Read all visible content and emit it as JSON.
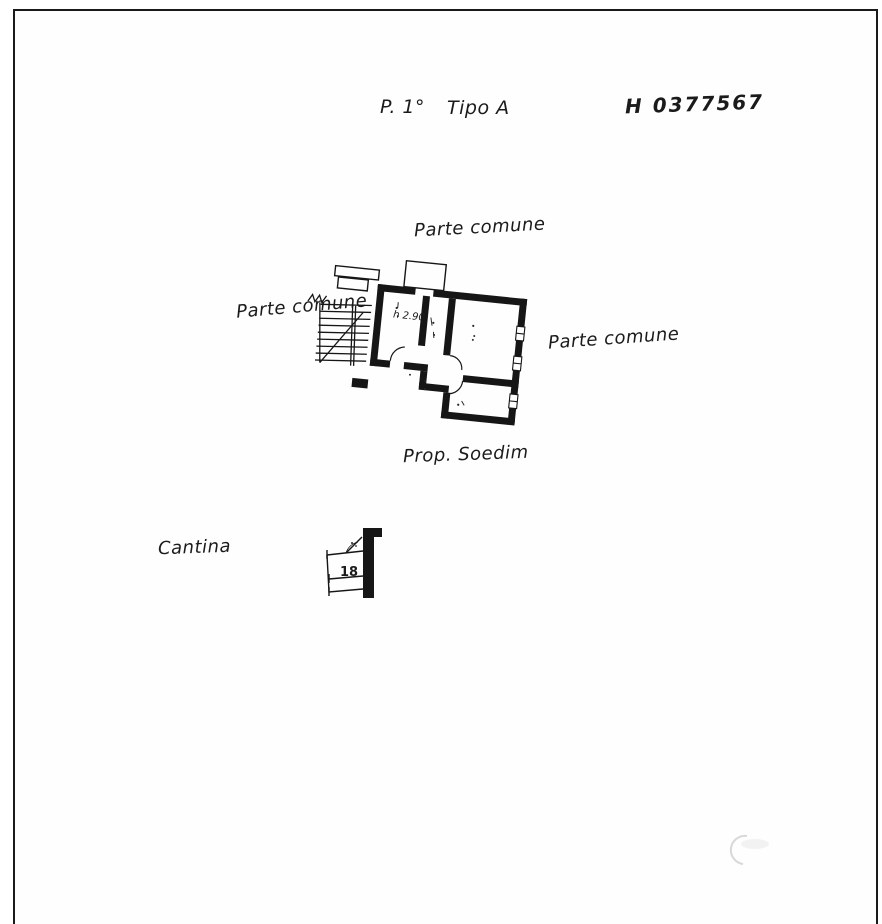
{
  "page": {
    "background": "#ffffff",
    "ink_color": "#1b1b1b",
    "border_color": "#1a1a1a",
    "faint_stamp_color": "#d8d8d8"
  },
  "header": {
    "floor_label": "P. 1°",
    "type_label": "Tipo A",
    "stamp_number": "H 0377567"
  },
  "plan_labels": {
    "common_area_top": "Parte comune",
    "common_area_left": "Parte comune",
    "common_area_right": "Parte comune",
    "owner_note": "Prop. Soedim",
    "cellar_label": "Cantina",
    "ceiling_height": "h 2.90",
    "cellar_number": "18"
  }
}
